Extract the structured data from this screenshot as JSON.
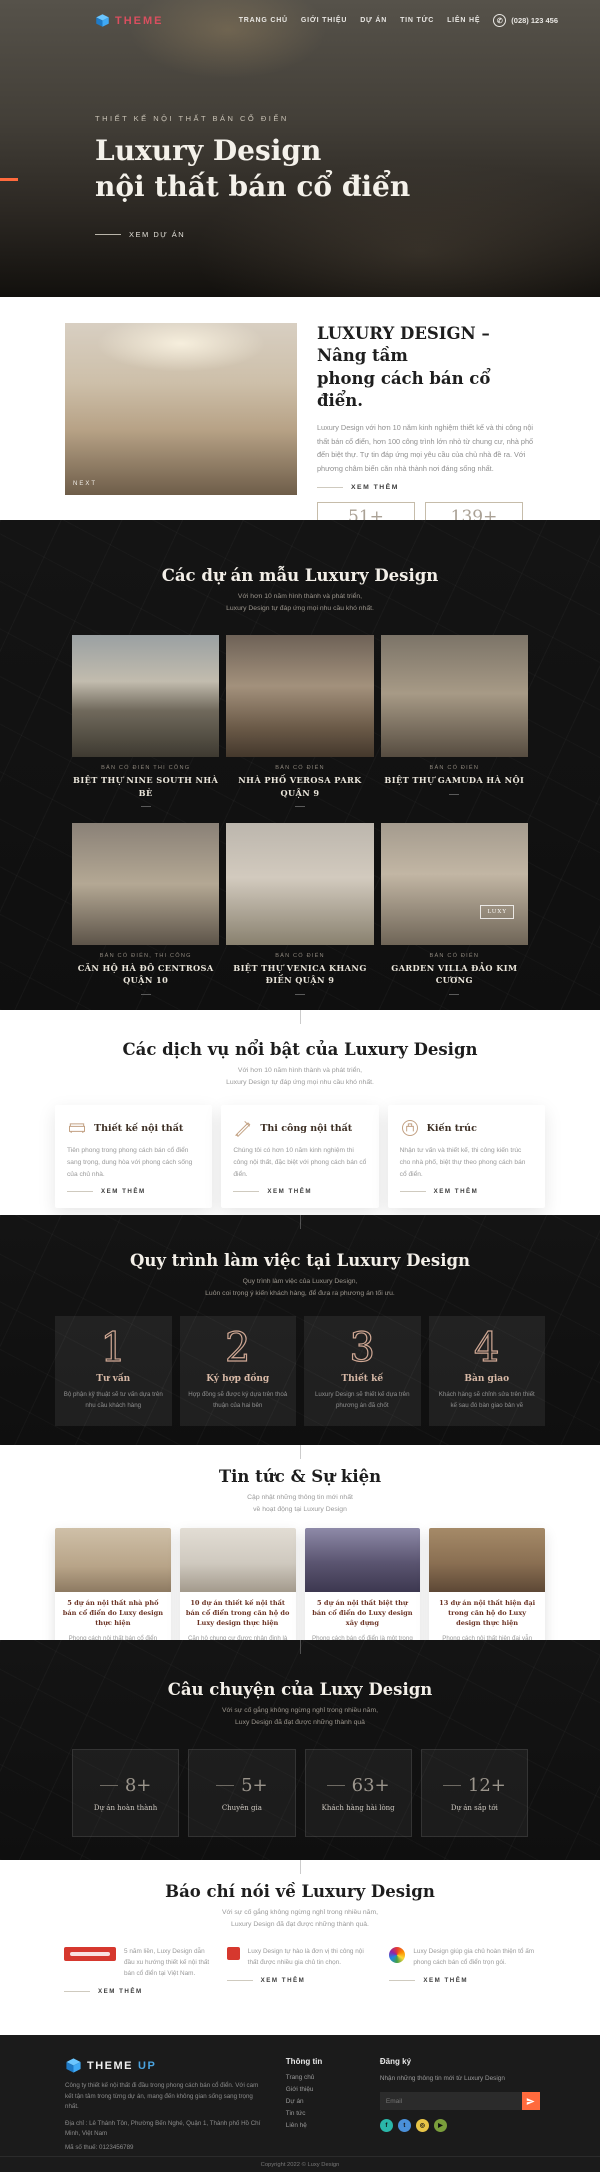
{
  "header": {
    "brand": "THEME",
    "nav": [
      {
        "label": "TRANG CHỦ"
      },
      {
        "label": "GIỚI THIỆU"
      },
      {
        "label": "DỰ ÁN"
      },
      {
        "label": "TIN TỨC"
      },
      {
        "label": "LIÊN HỆ"
      }
    ],
    "phone": "(028) 123 456"
  },
  "hero": {
    "eyebrow": "THIẾT KẾ NỘI THẤT BÁN CỔ ĐIỂN",
    "title_line1": "Luxury Design",
    "title_line2": "nội thất bán cổ điển",
    "cta": "XEM DỰ ÁN",
    "accent_color": "#ff6a3d"
  },
  "about": {
    "image_label": "NEXT",
    "title_line1": "LUXURY DESIGN – Nâng tầm",
    "title_line2": "phong cách bán cổ điển.",
    "body": "Luxury Design với hơn 10 năm kinh nghiệm thiết kế và thi công nội thất bán cổ điển, hơn 100 công trình lớn nhỏ từ chung cư, nhà phố đến biệt thự. Tự tin đáp ứng mọi yêu cầu của chủ nhà đề ra. Với phương châm biến căn nhà thành nơi đáng sống nhất.",
    "more": "XEM THÊM",
    "stats": [
      {
        "value": "51+",
        "label": "Công trình"
      },
      {
        "value": "139+",
        "label": "Khách hàng"
      }
    ]
  },
  "projects": {
    "title": "Các dự án mẫu Luxury Design",
    "subtitle1": "Với hơn 10 năm hình thành và phát triển,",
    "subtitle2": "Luxury Design tự đáp ứng mọi nhu cầu khó nhất.",
    "items": [
      {
        "tag": "BÁN CỔ ĐIỂN THI CÔNG",
        "name": "BIỆT THỰ NINE SOUTH NHÀ BÈ"
      },
      {
        "tag": "BÁN CỔ ĐIỂN",
        "name": "NHÀ PHỐ VEROSA PARK QUẬN 9"
      },
      {
        "tag": "BÁN CỔ ĐIỂN",
        "name": "BIỆT THỰ GAMUDA HÀ NỘI"
      },
      {
        "tag": "BÁN CỔ ĐIỂN, THI CÔNG",
        "name": "CĂN HỘ HÀ ĐÔ CENTROSA QUẬN 10"
      },
      {
        "tag": "BÁN CỔ ĐIỂN",
        "name": "BIỆT THỰ VENICA KHANG ĐIỀN QUẬN 9"
      },
      {
        "tag": "BÁN CỔ ĐIỂN",
        "name": "GARDEN VILLA ĐẢO KIM CƯƠNG",
        "badge": "LUXY"
      }
    ]
  },
  "services": {
    "title": "Các dịch vụ nổi bật của Luxury Design",
    "subtitle1": "Với hơn 10 năm hình thành và phát triển,",
    "subtitle2": "Luxury Design tự đáp ứng mọi nhu cầu khó nhất.",
    "items": [
      {
        "title": "Thiết kế nội thất",
        "body": "Tiên phong trong phong cách bán cổ điển sang trọng, dung hòa với phong cách sống của chủ nhà.",
        "more": "XEM THÊM"
      },
      {
        "title": "Thi công nội thất",
        "body": "Chúng tôi có hơn 10 năm kinh nghiệm thi công nội thất, đặc biệt với phong cách bán cổ điển.",
        "more": "XEM THÊM"
      },
      {
        "title": "Kiến trúc",
        "body": "Nhận tư vấn và thiết kế, thi công kiến trúc cho nhà phố, biệt thự theo phong cách bán cổ điển.",
        "more": "XEM THÊM"
      }
    ]
  },
  "process": {
    "title": "Quy trình làm việc tại Luxury Design",
    "subtitle1": "Quy trình làm việc của Luxury Design,",
    "subtitle2": "Luôn coi trọng ý kiến khách hàng, để đưa ra phương án tối ưu.",
    "steps": [
      {
        "number": "1",
        "title": "Tư vấn",
        "body": "Bộ phận kỹ thuật sẽ tư vấn dựa trên nhu cầu khách hàng"
      },
      {
        "number": "2",
        "title": "Ký hợp đồng",
        "body": "Hợp đồng sẽ được ký dựa trên thoả thuận của hai bên"
      },
      {
        "number": "3",
        "title": "Thiết kế",
        "body": "Luxury Design sẽ thiết kế dựa trên phương án đã chốt"
      },
      {
        "number": "4",
        "title": "Bàn giao",
        "body": "Khách hàng sẽ chỉnh sửa trên thiết kế sau đó bàn giao bản vẽ"
      }
    ]
  },
  "news": {
    "title": "Tin tức & Sự kiện",
    "subtitle1": "Cập nhật những thông tin mới nhất",
    "subtitle2": "về hoạt động tại Luxury Design",
    "items": [
      {
        "title": "5 dự án nội thất nhà phố bán cổ điển do Luxy design thực hiện",
        "body": "Phong cách nội thất bán cổ điển chính là sự kết hợp giữa truyền thống"
      },
      {
        "title": "10 dự án thiết kế nội thất bán cổ điển trong căn hộ do Luxy design thực hiện",
        "body": "Căn hộ chung cư được nhận định là có không gian nhỏ so với các"
      },
      {
        "title": "5 dự án nội thất biệt thự bán cổ điển do Luxy design xây dựng",
        "body": "Phong cách bán cổ điển là một trong những xu hướng được các gia chủ"
      },
      {
        "title": "13 dự án nội thất hiện đại trong căn hộ do Luxy design thực hiện",
        "body": "Phong cách nội thất hiện đại vẫn đang được các gia đình trẻ lựa chọn"
      }
    ]
  },
  "story": {
    "title": "Câu chuyện của Luxy Design",
    "subtitle1": "Với sự cố gắng không ngừng nghỉ trong nhiều năm,",
    "subtitle2": "Luxy Design đã đạt được những thành quả",
    "stats": [
      {
        "value": "8+",
        "label": "Dự án hoàn thành"
      },
      {
        "value": "5+",
        "label": "Chuyên gia"
      },
      {
        "value": "63+",
        "label": "Khách hàng hài lòng"
      },
      {
        "value": "12+",
        "label": "Dự án sắp tới"
      }
    ]
  },
  "press": {
    "title": "Báo chí nói về Luxury Design",
    "subtitle1": "Với sự cố gắng không ngừng nghỉ trong nhiều năm,",
    "subtitle2": "Luxury Design đã đạt được những thành quả.",
    "items": [
      {
        "body": "5 năm liền, Luxy Design dẫn đầu xu hướng thiết kế nội thất bán cổ điển tại Việt Nam.",
        "more": "XEM THÊM"
      },
      {
        "body": "Luxy Design tự hào là đơn vị thi công nội thất được nhiều gia chủ tin chọn.",
        "more": "XEM THÊM"
      },
      {
        "body": "Luxy Design giúp gia chủ hoàn thiện tổ ấm phong cách bán cổ điển trọn gói.",
        "more": "XEM THÊM"
      }
    ]
  },
  "footer": {
    "brand": "THEME",
    "brand_suffix": "UP",
    "about": "Công ty thiết kế nội thất đi đầu trong phong cách bán cổ điển. Với cam kết tận tâm trong từng dự án, mang đến không gian sống sang trọng nhất.",
    "address": "Địa chỉ : Lê Thánh Tôn, Phường Bến Nghé, Quận 1, Thành phố Hồ Chí Minh, Việt Nam",
    "tax": "Mã số thuế: 0123456789",
    "info_title": "Thông tin",
    "info_links": [
      {
        "label": "Trang chủ"
      },
      {
        "label": "Giới thiệu"
      },
      {
        "label": "Dự án"
      },
      {
        "label": "Tin tức"
      },
      {
        "label": "Liên hệ"
      }
    ],
    "subscribe_title": "Đăng ký",
    "subscribe_text": "Nhận những thông tin mới từ Luxury Design",
    "email_placeholder": "Email",
    "copyright": "Copyright 2022 © Luxy Design"
  }
}
